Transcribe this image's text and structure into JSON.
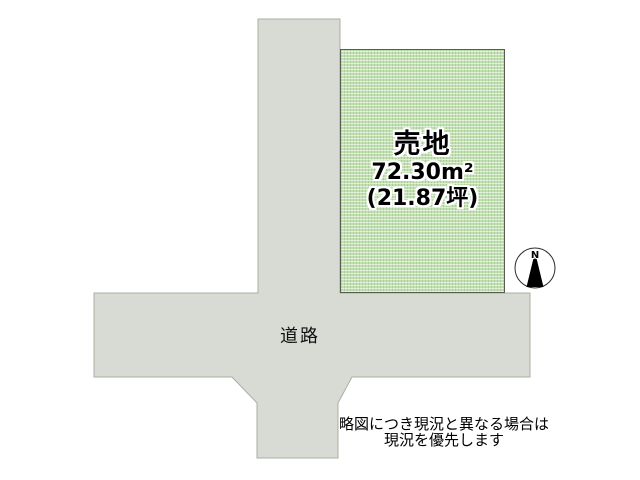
{
  "plot": {
    "title": "売地",
    "area_m2": "72.30m²",
    "area_tsubo": "(21.87坪)"
  },
  "road": {
    "label": "道路"
  },
  "compass": {
    "label": "N"
  },
  "disclaimer": {
    "line1": "略図につき現況と異なる場合は",
    "line2": "現況を優先します"
  },
  "colors": {
    "background": "#ffffff",
    "road_fill": "#d7dbd3",
    "road_border": "#a9afa6",
    "plot_fill": "#c2e0b2",
    "plot_border": "#565e52",
    "text": "#000000",
    "halo": "#ffffff"
  }
}
